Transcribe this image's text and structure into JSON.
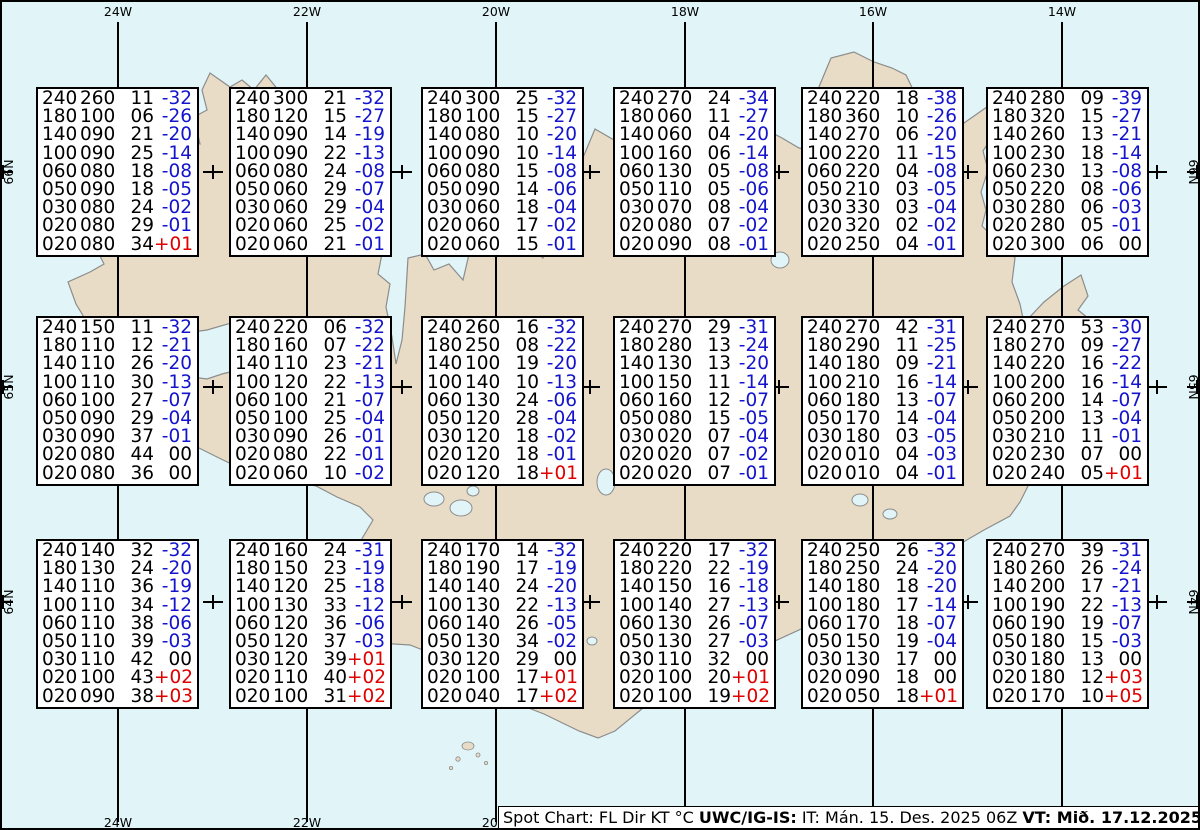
{
  "colors": {
    "ocean": "#E1F5F9",
    "land": "#E9DCC7",
    "coast": "#8C8C8C",
    "temp_negative": "#1414CC",
    "temp_positive": "#E00000",
    "temp_zero": "#000000",
    "graticule": "#000000"
  },
  "map": {
    "meridians": [
      {
        "label": "24W",
        "x": 116
      },
      {
        "label": "22W",
        "x": 305
      },
      {
        "label": "20W",
        "x": 494
      },
      {
        "label": "18W",
        "x": 683
      },
      {
        "label": "16W",
        "x": 871
      },
      {
        "label": "14W",
        "x": 1060
      }
    ],
    "parallels": [
      {
        "label": "66N",
        "y": 170
      },
      {
        "label": "65N",
        "y": 385
      },
      {
        "label": "64N",
        "y": 600
      }
    ],
    "cross_x": [
      211,
      400,
      588,
      777,
      966,
      1155
    ]
  },
  "legend": {
    "columns": [
      "FL",
      "Dir",
      "KT",
      "°C"
    ],
    "flight_levels": [
      "240",
      "180",
      "140",
      "100",
      "060",
      "050",
      "030",
      "020",
      "020"
    ]
  },
  "stations": [
    {
      "x": 34,
      "y": 85,
      "rows": [
        [
          "240",
          "260",
          "11",
          "-32"
        ],
        [
          "180",
          "100",
          "06",
          "-26"
        ],
        [
          "140",
          "090",
          "21",
          "-20"
        ],
        [
          "100",
          "090",
          "25",
          "-14"
        ],
        [
          "060",
          "080",
          "18",
          "-08"
        ],
        [
          "050",
          "090",
          "18",
          "-05"
        ],
        [
          "030",
          "080",
          "24",
          "-02"
        ],
        [
          "020",
          "080",
          "29",
          "-01"
        ],
        [
          "020",
          "080",
          "34",
          "+01"
        ]
      ]
    },
    {
      "x": 227,
      "y": 85,
      "rows": [
        [
          "240",
          "300",
          "21",
          "-32"
        ],
        [
          "180",
          "120",
          "15",
          "-27"
        ],
        [
          "140",
          "090",
          "14",
          "-19"
        ],
        [
          "100",
          "090",
          "22",
          "-13"
        ],
        [
          "060",
          "080",
          "24",
          "-08"
        ],
        [
          "050",
          "060",
          "29",
          "-07"
        ],
        [
          "030",
          "060",
          "29",
          "-04"
        ],
        [
          "020",
          "060",
          "25",
          "-02"
        ],
        [
          "020",
          "060",
          "21",
          "-01"
        ]
      ]
    },
    {
      "x": 419,
      "y": 85,
      "rows": [
        [
          "240",
          "300",
          "25",
          "-32"
        ],
        [
          "180",
          "100",
          "15",
          "-27"
        ],
        [
          "140",
          "080",
          "10",
          "-20"
        ],
        [
          "100",
          "090",
          "10",
          "-14"
        ],
        [
          "060",
          "080",
          "15",
          "-08"
        ],
        [
          "050",
          "090",
          "14",
          "-06"
        ],
        [
          "030",
          "060",
          "18",
          "-04"
        ],
        [
          "020",
          "060",
          "17",
          "-02"
        ],
        [
          "020",
          "060",
          "15",
          "-01"
        ]
      ]
    },
    {
      "x": 611,
      "y": 85,
      "rows": [
        [
          "240",
          "270",
          "24",
          "-34"
        ],
        [
          "180",
          "060",
          "11",
          "-27"
        ],
        [
          "140",
          "060",
          "04",
          "-20"
        ],
        [
          "100",
          "160",
          "06",
          "-14"
        ],
        [
          "060",
          "130",
          "05",
          "-08"
        ],
        [
          "050",
          "110",
          "05",
          "-06"
        ],
        [
          "030",
          "070",
          "08",
          "-04"
        ],
        [
          "020",
          "080",
          "07",
          "-02"
        ],
        [
          "020",
          "090",
          "08",
          "-01"
        ]
      ]
    },
    {
      "x": 799,
      "y": 85,
      "rows": [
        [
          "240",
          "220",
          "18",
          "-38"
        ],
        [
          "180",
          "360",
          "10",
          "-26"
        ],
        [
          "140",
          "270",
          "06",
          "-20"
        ],
        [
          "100",
          "220",
          "11",
          "-15"
        ],
        [
          "060",
          "220",
          "04",
          "-08"
        ],
        [
          "050",
          "210",
          "03",
          "-05"
        ],
        [
          "030",
          "330",
          "03",
          "-04"
        ],
        [
          "020",
          "320",
          "02",
          "-02"
        ],
        [
          "020",
          "250",
          "04",
          "-01"
        ]
      ]
    },
    {
      "x": 984,
      "y": 85,
      "rows": [
        [
          "240",
          "280",
          "09",
          "-39"
        ],
        [
          "180",
          "320",
          "15",
          "-27"
        ],
        [
          "140",
          "260",
          "13",
          "-21"
        ],
        [
          "100",
          "230",
          "18",
          "-14"
        ],
        [
          "060",
          "230",
          "13",
          "-08"
        ],
        [
          "050",
          "220",
          "08",
          "-06"
        ],
        [
          "030",
          "280",
          "06",
          "-03"
        ],
        [
          "020",
          "280",
          "05",
          "-01"
        ],
        [
          "020",
          "300",
          "06",
          "00"
        ]
      ]
    },
    {
      "x": 34,
      "y": 314,
      "rows": [
        [
          "240",
          "150",
          "11",
          "-32"
        ],
        [
          "180",
          "110",
          "12",
          "-21"
        ],
        [
          "140",
          "110",
          "26",
          "-20"
        ],
        [
          "100",
          "110",
          "30",
          "-13"
        ],
        [
          "060",
          "100",
          "27",
          "-07"
        ],
        [
          "050",
          "090",
          "29",
          "-04"
        ],
        [
          "030",
          "090",
          "37",
          "-01"
        ],
        [
          "020",
          "080",
          "44",
          "00"
        ],
        [
          "020",
          "080",
          "36",
          "00"
        ]
      ]
    },
    {
      "x": 227,
      "y": 314,
      "rows": [
        [
          "240",
          "220",
          "06",
          "-32"
        ],
        [
          "180",
          "160",
          "07",
          "-22"
        ],
        [
          "140",
          "110",
          "23",
          "-21"
        ],
        [
          "100",
          "120",
          "22",
          "-13"
        ],
        [
          "060",
          "100",
          "21",
          "-07"
        ],
        [
          "050",
          "100",
          "25",
          "-04"
        ],
        [
          "030",
          "090",
          "26",
          "-01"
        ],
        [
          "020",
          "080",
          "22",
          "-01"
        ],
        [
          "020",
          "060",
          "10",
          "-02"
        ]
      ]
    },
    {
      "x": 419,
      "y": 314,
      "rows": [
        [
          "240",
          "260",
          "16",
          "-32"
        ],
        [
          "180",
          "250",
          "08",
          "-22"
        ],
        [
          "140",
          "100",
          "19",
          "-20"
        ],
        [
          "100",
          "140",
          "10",
          "-13"
        ],
        [
          "060",
          "130",
          "24",
          "-06"
        ],
        [
          "050",
          "120",
          "28",
          "-04"
        ],
        [
          "030",
          "120",
          "18",
          "-02"
        ],
        [
          "020",
          "120",
          "18",
          "-01"
        ],
        [
          "020",
          "120",
          "18",
          "+01"
        ]
      ]
    },
    {
      "x": 611,
      "y": 314,
      "rows": [
        [
          "240",
          "270",
          "29",
          "-31"
        ],
        [
          "180",
          "280",
          "13",
          "-24"
        ],
        [
          "140",
          "130",
          "13",
          "-20"
        ],
        [
          "100",
          "150",
          "11",
          "-14"
        ],
        [
          "060",
          "160",
          "12",
          "-07"
        ],
        [
          "050",
          "080",
          "15",
          "-05"
        ],
        [
          "030",
          "020",
          "07",
          "-04"
        ],
        [
          "020",
          "020",
          "07",
          "-02"
        ],
        [
          "020",
          "020",
          "07",
          "-01"
        ]
      ]
    },
    {
      "x": 799,
      "y": 314,
      "rows": [
        [
          "240",
          "270",
          "42",
          "-31"
        ],
        [
          "180",
          "290",
          "11",
          "-25"
        ],
        [
          "140",
          "180",
          "09",
          "-21"
        ],
        [
          "100",
          "210",
          "16",
          "-14"
        ],
        [
          "060",
          "180",
          "13",
          "-07"
        ],
        [
          "050",
          "170",
          "14",
          "-04"
        ],
        [
          "030",
          "180",
          "03",
          "-05"
        ],
        [
          "020",
          "010",
          "04",
          "-03"
        ],
        [
          "020",
          "010",
          "04",
          "-01"
        ]
      ]
    },
    {
      "x": 984,
      "y": 314,
      "rows": [
        [
          "240",
          "270",
          "53",
          "-30"
        ],
        [
          "180",
          "270",
          "09",
          "-27"
        ],
        [
          "140",
          "220",
          "16",
          "-22"
        ],
        [
          "100",
          "200",
          "16",
          "-14"
        ],
        [
          "060",
          "200",
          "14",
          "-07"
        ],
        [
          "050",
          "200",
          "13",
          "-04"
        ],
        [
          "030",
          "210",
          "11",
          "-01"
        ],
        [
          "020",
          "230",
          "07",
          "00"
        ],
        [
          "020",
          "240",
          "05",
          "+01"
        ]
      ]
    },
    {
      "x": 34,
      "y": 537,
      "rows": [
        [
          "240",
          "140",
          "32",
          "-32"
        ],
        [
          "180",
          "130",
          "24",
          "-20"
        ],
        [
          "140",
          "110",
          "36",
          "-19"
        ],
        [
          "100",
          "110",
          "34",
          "-12"
        ],
        [
          "060",
          "110",
          "38",
          "-06"
        ],
        [
          "050",
          "110",
          "39",
          "-03"
        ],
        [
          "030",
          "110",
          "42",
          "00"
        ],
        [
          "020",
          "100",
          "43",
          "+02"
        ],
        [
          "020",
          "090",
          "38",
          "+03"
        ]
      ]
    },
    {
      "x": 227,
      "y": 537,
      "rows": [
        [
          "240",
          "160",
          "24",
          "-31"
        ],
        [
          "180",
          "150",
          "23",
          "-19"
        ],
        [
          "140",
          "120",
          "25",
          "-18"
        ],
        [
          "100",
          "130",
          "33",
          "-12"
        ],
        [
          "060",
          "120",
          "36",
          "-06"
        ],
        [
          "050",
          "120",
          "37",
          "-03"
        ],
        [
          "030",
          "120",
          "39",
          "+01"
        ],
        [
          "020",
          "110",
          "40",
          "+02"
        ],
        [
          "020",
          "100",
          "31",
          "+02"
        ]
      ]
    },
    {
      "x": 419,
      "y": 537,
      "rows": [
        [
          "240",
          "170",
          "14",
          "-32"
        ],
        [
          "180",
          "190",
          "17",
          "-19"
        ],
        [
          "140",
          "140",
          "24",
          "-20"
        ],
        [
          "100",
          "130",
          "22",
          "-13"
        ],
        [
          "060",
          "140",
          "26",
          "-05"
        ],
        [
          "050",
          "130",
          "34",
          "-02"
        ],
        [
          "030",
          "120",
          "29",
          "00"
        ],
        [
          "020",
          "100",
          "17",
          "+01"
        ],
        [
          "020",
          "040",
          "17",
          "+02"
        ]
      ]
    },
    {
      "x": 611,
      "y": 537,
      "rows": [
        [
          "240",
          "220",
          "17",
          "-32"
        ],
        [
          "180",
          "220",
          "22",
          "-19"
        ],
        [
          "140",
          "150",
          "16",
          "-18"
        ],
        [
          "100",
          "140",
          "27",
          "-13"
        ],
        [
          "060",
          "130",
          "26",
          "-07"
        ],
        [
          "050",
          "130",
          "27",
          "-03"
        ],
        [
          "030",
          "110",
          "32",
          "00"
        ],
        [
          "020",
          "100",
          "20",
          "+01"
        ],
        [
          "020",
          "100",
          "19",
          "+02"
        ]
      ]
    },
    {
      "x": 799,
      "y": 537,
      "rows": [
        [
          "240",
          "250",
          "26",
          "-32"
        ],
        [
          "180",
          "250",
          "24",
          "-20"
        ],
        [
          "140",
          "180",
          "18",
          "-20"
        ],
        [
          "100",
          "180",
          "17",
          "-14"
        ],
        [
          "060",
          "170",
          "18",
          "-07"
        ],
        [
          "050",
          "150",
          "19",
          "-04"
        ],
        [
          "030",
          "130",
          "17",
          "00"
        ],
        [
          "020",
          "090",
          "18",
          "00"
        ],
        [
          "020",
          "050",
          "18",
          "+01"
        ]
      ]
    },
    {
      "x": 984,
      "y": 537,
      "rows": [
        [
          "240",
          "270",
          "39",
          "-31"
        ],
        [
          "180",
          "260",
          "26",
          "-24"
        ],
        [
          "140",
          "200",
          "17",
          "-21"
        ],
        [
          "100",
          "190",
          "22",
          "-13"
        ],
        [
          "060",
          "190",
          "19",
          "-07"
        ],
        [
          "050",
          "180",
          "15",
          "-03"
        ],
        [
          "030",
          "180",
          "13",
          "00"
        ],
        [
          "020",
          "180",
          "12",
          "+03"
        ],
        [
          "020",
          "170",
          "10",
          "+05"
        ]
      ]
    }
  ],
  "status_bar": {
    "segments": [
      {
        "text": "Spot Chart: FL Dir KT °C ",
        "bold": false
      },
      {
        "text": "UWC/IG-IS:",
        "bold": true
      },
      {
        "text": " IT: Mán. 15. Des. 2025 06Z ",
        "bold": false
      },
      {
        "text": "VT: Mið. 17.12.2025 00Z",
        "bold": true
      },
      {
        "text": " (+42 h)",
        "bold": false
      }
    ]
  }
}
